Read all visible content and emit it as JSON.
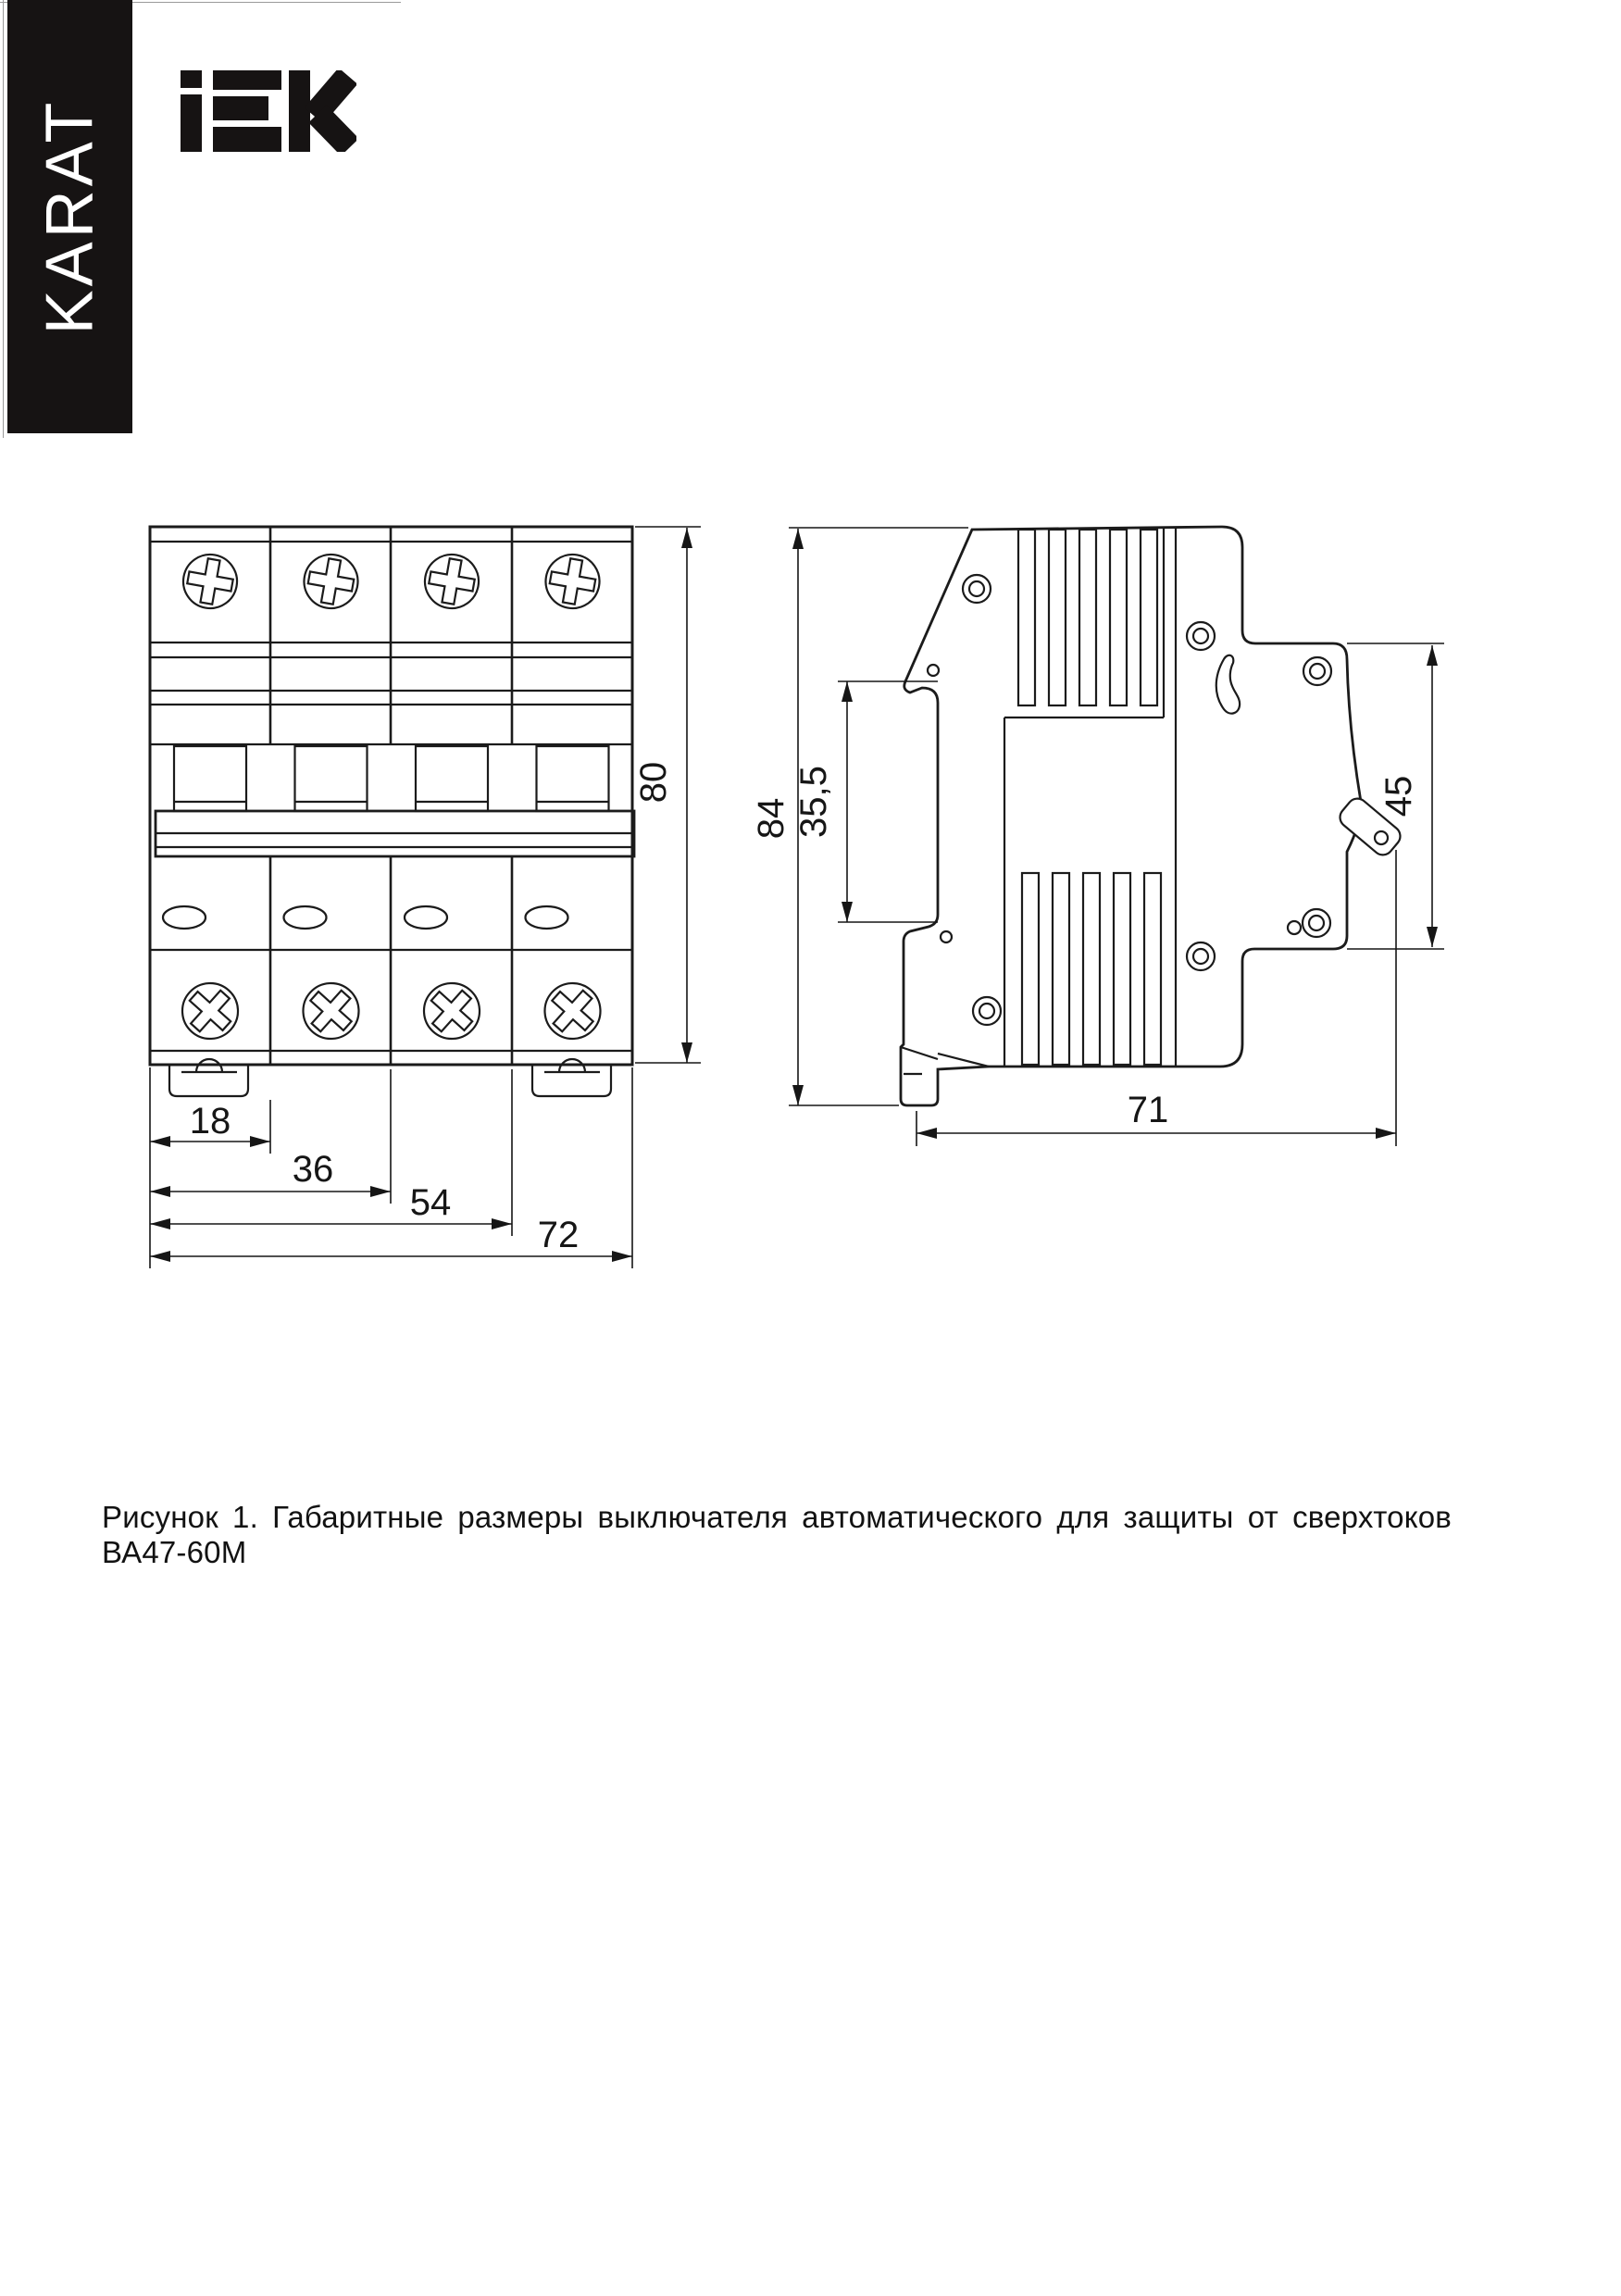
{
  "brand": {
    "karat_label": "KARAT",
    "logo_text": "iEK"
  },
  "front_view": {
    "title": "front view of 4-pole circuit breaker",
    "dimensions": {
      "module_width": "18",
      "two_modules": "36",
      "three_modules": "54",
      "total_width": "72",
      "height": "80"
    }
  },
  "side_view": {
    "title": "side profile of circuit breaker",
    "dimensions": {
      "total_height": "84",
      "din_recess": "35,5",
      "front_height": "45",
      "depth": "71"
    }
  },
  "caption": {
    "text": "Рисунок 1. Габаритные размеры выключателя автоматического для защиты от сверхтоков ВА47-60М"
  }
}
